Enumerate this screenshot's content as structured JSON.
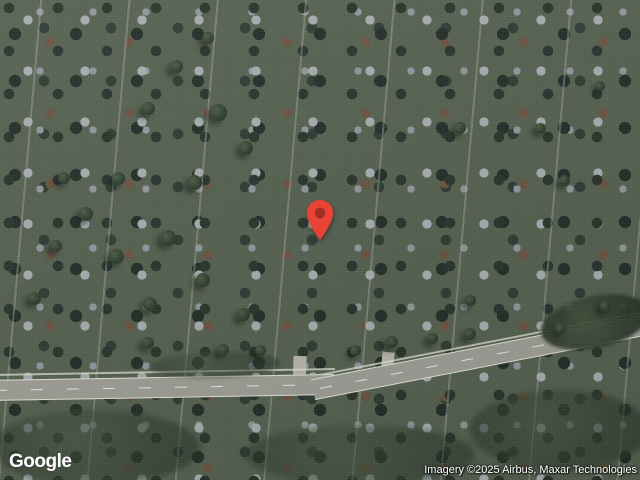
{
  "ui": {
    "logo_text": "Google",
    "attribution_text": "Imagery ©2025 Airbus, Maxar Technologies"
  },
  "marker": {
    "x": 320,
    "y": 241,
    "color": "#EA4335",
    "dot_color": "#A52E24"
  },
  "colors": {
    "pin_red": "#EA4335",
    "pin_inner": "#A52E24",
    "watermark_text": "#FFFFFF",
    "terrain_base": "#85906A",
    "road_gray": "#9C9C94",
    "roof_terracotta": "#C28166",
    "roof_white": "#EAEBE4"
  },
  "map": {
    "features": [
      {
        "n": "terrain-base",
        "x": 0,
        "y": 0,
        "w": 640,
        "h": 480,
        "bg": "linear-gradient(120deg,#8b9370 0%,#7f8a5f 45%,#87906c 100%)"
      },
      {
        "n": "field-north",
        "x": 140,
        "y": -8,
        "w": 510,
        "h": 150,
        "bg": "#7d8f55",
        "cls": "tex-field",
        "rot": -2
      },
      {
        "n": "field-northeast",
        "x": 470,
        "y": 8,
        "w": 180,
        "h": 82,
        "bg": "#95a164",
        "cls": "tex-field",
        "rot": -4,
        "op": 0.95
      },
      {
        "n": "campus-lawn",
        "x": 190,
        "y": 85,
        "w": 280,
        "h": 200,
        "bg": "radial-gradient(closest-side, #7f9052 0%, #748549 70%, rgba(116,133,73,0) 100%)"
      },
      {
        "n": "field-berm",
        "x": 241,
        "y": 26,
        "w": 212,
        "h": 76,
        "bg": "#6e7d49",
        "cls": "tex-field",
        "rot": -3,
        "br": "6px",
        "bd": "1px solid rgba(70,80,45,.55)"
      },
      {
        "n": "dirt-patch",
        "x": 286,
        "y": 58,
        "w": 54,
        "h": 18,
        "bg": "#c2b189",
        "rot": -4,
        "br": "4px"
      },
      {
        "n": "field-path",
        "x": 473,
        "y": 6,
        "w": 3,
        "h": 58,
        "bg": "rgba(225,223,210,.75)",
        "rot": 4
      },
      {
        "n": "field-shed",
        "x": 461,
        "y": 51,
        "w": 20,
        "h": 12,
        "bg": "#e3e3da",
        "rot": -8,
        "bd": "1px solid #4a4f45"
      },
      {
        "n": "suburb-northwest",
        "x": 0,
        "y": 0,
        "w": 640,
        "h": 480,
        "cls": "tex-suburb",
        "clip": "polygon(0 0, 352 0, 286 72, 224 142, 94 290, 36 330, 0 352)"
      },
      {
        "n": "tree-line",
        "x": 300,
        "y": 98,
        "w": 120,
        "h": 58,
        "cls": "dark-mass",
        "bl": 2,
        "op": 0.95
      },
      {
        "n": "tree-line",
        "x": 395,
        "y": 80,
        "w": 120,
        "h": 55,
        "cls": "dark-mass",
        "bl": 2,
        "op": 0.95
      },
      {
        "n": "tree-line",
        "x": 490,
        "y": 55,
        "w": 120,
        "h": 55,
        "cls": "dark-mass",
        "bl": 2,
        "op": 0.95
      },
      {
        "n": "tree-line",
        "x": 580,
        "y": 28,
        "w": 95,
        "h": 52,
        "cls": "dark-mass",
        "bl": 2,
        "op": 0.95
      },
      {
        "n": "tree-cluster",
        "x": 585,
        "y": -12,
        "w": 80,
        "h": 48,
        "cls": "dark-mass",
        "bl": 2,
        "op": 0.92
      },
      {
        "n": "woods-central",
        "x": 315,
        "y": 115,
        "w": 120,
        "h": 85,
        "cls": "dark-mass",
        "bl": 2,
        "op": 0.92
      },
      {
        "n": "woods-central",
        "x": 395,
        "y": 128,
        "w": 135,
        "h": 80,
        "cls": "dark-mass",
        "bl": 2,
        "op": 0.9
      },
      {
        "n": "woods-central",
        "x": 455,
        "y": 140,
        "w": 90,
        "h": 55,
        "cls": "dark-mass",
        "bl": 2,
        "op": 0.88
      },
      {
        "n": "woods-west",
        "x": 235,
        "y": 118,
        "w": 105,
        "h": 48,
        "cls": "dark-mass",
        "rot": -15,
        "bl": 2,
        "op": 0.9
      },
      {
        "n": "woods-west",
        "x": 172,
        "y": 146,
        "w": 85,
        "h": 42,
        "cls": "dark-mass",
        "rot": -25,
        "bl": 2,
        "op": 0.88
      },
      {
        "n": "suburb-edge-trees",
        "x": 288,
        "y": 30,
        "w": 90,
        "h": 48,
        "cls": "dark-mass",
        "rot": -35,
        "bl": 2,
        "op": 0.85
      },
      {
        "n": "suburb-edge-trees",
        "x": 210,
        "y": 95,
        "w": 95,
        "h": 50,
        "cls": "dark-mass",
        "rot": -38,
        "bl": 2,
        "op": 0.85
      },
      {
        "n": "suburb-edge-trees",
        "x": 130,
        "y": 190,
        "w": 90,
        "h": 50,
        "cls": "dark-mass",
        "rot": -48,
        "bl": 2,
        "op": 0.85
      },
      {
        "n": "suburb-edge-trees",
        "x": 60,
        "y": 270,
        "w": 85,
        "h": 46,
        "cls": "dark-mass",
        "rot": -40,
        "bl": 2,
        "op": 0.85
      },
      {
        "n": "suburb-edge-trees",
        "x": 5,
        "y": 330,
        "w": 70,
        "h": 42,
        "cls": "dark-mass",
        "rot": -30,
        "bl": 2,
        "op": 0.85
      },
      {
        "n": "gravel-lot",
        "x": 14,
        "y": 326,
        "w": 130,
        "h": 26,
        "bg": "#c8bfa6",
        "rot": -3,
        "br": "3px",
        "op": 0.95
      },
      {
        "n": "gravel-driveway",
        "x": 135,
        "y": 333,
        "w": 90,
        "h": 12,
        "bg": "#c2b99f",
        "rot": -2,
        "op": 0.85
      },
      {
        "n": "gravel-spur",
        "x": 52,
        "y": 298,
        "w": 24,
        "h": 34,
        "bg": "#c0b79e",
        "rot": -10,
        "op": 0.8
      },
      {
        "n": "barn",
        "x": 100,
        "y": 266,
        "w": 28,
        "h": 20,
        "bg": "#5e625a",
        "rot": 6,
        "cls": "bldg"
      },
      {
        "n": "barn",
        "x": 117,
        "y": 290,
        "w": 33,
        "h": 22,
        "bg": "#51574f",
        "rot": -4,
        "cls": "bldg"
      },
      {
        "n": "barn",
        "x": 136,
        "y": 312,
        "w": 26,
        "h": 16,
        "bg": "#6c7065",
        "rot": -4,
        "cls": "bldg"
      },
      {
        "n": "farm-path",
        "x": 150,
        "y": 255,
        "w": 75,
        "h": 4,
        "bg": "rgba(205,200,185,.6)",
        "rot": 6
      },
      {
        "n": "campus-loop-road",
        "x": 212,
        "y": 148,
        "w": 232,
        "h": 162,
        "bg": "rgba(0,0,0,0)",
        "bd": "9px solid rgba(190,188,176,.92)",
        "br": "50%",
        "rot": -8
      },
      {
        "n": "loop-parking-west",
        "x": 213,
        "y": 190,
        "w": 46,
        "h": 95,
        "bg": "rgba(193,191,179,.85)",
        "br": "50%",
        "rot": 12
      },
      {
        "n": "loop-road-north",
        "x": 255,
        "y": 146,
        "w": 90,
        "h": 22,
        "bg": "rgba(193,191,179,.8)",
        "br": "50%",
        "rot": -10
      },
      {
        "n": "service-road",
        "x": 352,
        "y": 132,
        "w": 70,
        "h": 9,
        "bg": "#b3b1a6",
        "rot": -18
      },
      {
        "n": "service-road",
        "x": 430,
        "y": 200,
        "w": 60,
        "h": 10,
        "bg": "#b3b1a6",
        "rot": -12
      },
      {
        "n": "connector-road",
        "x": 497,
        "y": 248,
        "w": 12,
        "h": 102,
        "bg": "#b3b1a6",
        "rot": 9
      },
      {
        "n": "parking-lot",
        "x": 368,
        "y": 152,
        "w": 135,
        "h": 68,
        "bg": "#a8a7a0",
        "cls": "tex-parking",
        "rot": -12,
        "br": "4px"
      },
      {
        "n": "parking-lot",
        "x": 388,
        "y": 232,
        "w": 118,
        "h": 64,
        "bg": "#a8a7a0",
        "cls": "tex-parking",
        "rot": -9,
        "br": "4px"
      },
      {
        "n": "parking-lot",
        "x": 560,
        "y": 100,
        "w": 78,
        "h": 34,
        "bg": "#a8a7a0",
        "cls": "tex-parking",
        "rot": -12,
        "br": "3px"
      },
      {
        "n": "parking-lot",
        "x": 545,
        "y": 254,
        "w": 95,
        "h": 44,
        "bg": "#a8a7a0",
        "cls": "tex-parking",
        "rot": -14,
        "br": "10px"
      },
      {
        "n": "parking-strip",
        "x": 196,
        "y": 148,
        "w": 70,
        "h": 24,
        "bg": "#b4b2a8",
        "cls": "tex-parking",
        "rot": -26,
        "br": "10px",
        "op": 0.9
      },
      {
        "n": "garden-plot",
        "x": 410,
        "y": 290,
        "w": 28,
        "h": 26,
        "bg": "#41493c",
        "bd": "2px solid #2d342b",
        "rot": -8
      },
      {
        "n": "garden-plot",
        "x": 442,
        "y": 287,
        "w": 28,
        "h": 26,
        "bg": "#8d7356",
        "bd": "2px solid #2d342b",
        "rot": -8
      },
      {
        "n": "school-building",
        "x": 436,
        "y": 170,
        "w": 74,
        "h": 26,
        "bg": "#eaebe4",
        "rot": -12,
        "cls": "bldg"
      },
      {
        "n": "school-building",
        "x": 519,
        "y": 148,
        "w": 80,
        "h": 26,
        "bg": "#e7e8e1",
        "rot": -12,
        "cls": "bldg"
      },
      {
        "n": "school-building",
        "x": 451,
        "y": 206,
        "w": 66,
        "h": 24,
        "bg": "#eaebe4",
        "rot": -12,
        "cls": "bldg"
      },
      {
        "n": "school-building",
        "x": 527,
        "y": 218,
        "w": 78,
        "h": 26,
        "bg": "#e4e5de",
        "rot": -12,
        "cls": "bldg"
      },
      {
        "n": "school-building",
        "x": 466,
        "y": 246,
        "w": 72,
        "h": 23,
        "bg": "#e9eae3",
        "rot": -12,
        "cls": "bldg"
      },
      {
        "n": "school-building",
        "x": 601,
        "y": 246,
        "w": 34,
        "h": 20,
        "bg": "#dfe0d9",
        "rot": -12,
        "cls": "bldg"
      },
      {
        "n": "school-building",
        "x": 616,
        "y": 192,
        "w": 26,
        "h": 52,
        "bg": "#d9dad2",
        "rot": -12,
        "cls": "bldg"
      },
      {
        "n": "campus-building-gray",
        "x": 270,
        "y": 204,
        "w": 64,
        "h": 48,
        "bg": "linear-gradient(140deg,#b3b8bc 0%,#8f959a 55%,#7f858a 100%)",
        "rot": -9,
        "cls": "bldg",
        "br": "2px"
      },
      {
        "n": "campus-building-gray",
        "x": 330,
        "y": 208,
        "w": 42,
        "h": 30,
        "bg": "#9aa1a6",
        "rot": -9,
        "cls": "bldg",
        "br": "2px"
      },
      {
        "n": "courtyard-roof",
        "x": 312,
        "y": 234,
        "w": 52,
        "h": 38,
        "bg": "#c28c6e",
        "rot": -9,
        "br": "3px",
        "op": 0.95
      },
      {
        "n": "building-link",
        "x": 312,
        "y": 254,
        "w": 18,
        "h": 46,
        "bg": "#bf8165",
        "rot": -4,
        "op": 0.9
      },
      {
        "n": "campus-building-orange",
        "x": 293,
        "y": 295,
        "w": 48,
        "h": 52,
        "bg": "#c07a5d",
        "rot": 45,
        "cls": "bldg",
        "br": "4px"
      },
      {
        "n": "campus-building-orange",
        "x": 291,
        "y": 299,
        "w": 56,
        "h": 44,
        "bg": "#c48166",
        "rot": -45,
        "cls": "bldg",
        "br": "4px"
      },
      {
        "n": "campus-building-center",
        "x": 306,
        "y": 309,
        "w": 26,
        "h": 24,
        "bg": "#d9c9b9",
        "rot": -8,
        "br": "2px"
      },
      {
        "n": "campus-building-white",
        "x": 330,
        "y": 320,
        "w": 24,
        "h": 26,
        "bg": "#e7e4db",
        "rot": -8,
        "cls": "bldg",
        "br": "2px"
      },
      {
        "n": "walking-path",
        "x": 178,
        "y": 170,
        "w": 48,
        "h": 3,
        "bg": "rgba(210,207,193,.7)",
        "rot": 9
      },
      {
        "n": "walking-path",
        "x": 536,
        "y": 148,
        "w": 3,
        "h": 56,
        "bg": "rgba(215,212,198,.65)",
        "rot": 18
      },
      {
        "n": "walking-path",
        "x": 352,
        "y": 300,
        "w": 3,
        "h": 54,
        "bg": "rgba(215,212,198,.6)",
        "rot": -12
      },
      {
        "n": "suburb-south",
        "x": 0,
        "y": 0,
        "w": 640,
        "h": 480,
        "cls": "tex-burbdark",
        "clip": "polygon(0 397, 330 395, 640 343, 640 480, 0 480)"
      },
      {
        "n": "entrance-road",
        "x": 293,
        "y": 356,
        "w": 13,
        "h": 34,
        "bg": "#b6b4a9",
        "rot": 2
      },
      {
        "n": "entrance-road",
        "x": 381,
        "y": 352,
        "w": 12,
        "h": 32,
        "bg": "#b6b4a9",
        "rot": 6
      },
      {
        "n": "sidewalk",
        "x": -10,
        "y": 371,
        "w": 345,
        "h": 2,
        "bg": "rgba(222,222,212,.75)",
        "rot": -1
      },
      {
        "n": "sidewalk",
        "x": 314,
        "y": 342,
        "w": 340,
        "h": 2,
        "bg": "rgba(222,222,212,.75)",
        "rot": -11
      },
      {
        "n": "main-road",
        "x": -12,
        "y": 377,
        "w": 346,
        "h": 19,
        "bg": "#9c9c94",
        "rot": -1,
        "cls": "road"
      },
      {
        "n": "main-road",
        "x": 310,
        "y": 346,
        "w": 348,
        "h": 19,
        "bg": "#9c9c94",
        "rot": -11,
        "cls": "road"
      },
      {
        "n": "tree-cluster",
        "x": 540,
        "y": 296,
        "w": 110,
        "h": 52,
        "cls": "dark-mass",
        "rot": -12,
        "bl": 1.5,
        "op": 0.92
      },
      {
        "n": "tree-cluster",
        "x": 150,
        "y": 352,
        "w": 130,
        "h": 26,
        "cls": "dark-mass",
        "rot": -2,
        "bl": 2,
        "op": 0.5
      },
      {
        "n": "tree-canopy-shadow",
        "x": -10,
        "y": 410,
        "w": 210,
        "h": 75,
        "cls": "dark-mass",
        "bl": 3,
        "op": 0.55
      },
      {
        "n": "tree-canopy-shadow",
        "x": 245,
        "y": 425,
        "w": 230,
        "h": 60,
        "cls": "dark-mass",
        "bl": 3,
        "op": 0.5
      },
      {
        "n": "tree-canopy-shadow",
        "x": 470,
        "y": 390,
        "w": 180,
        "h": 80,
        "cls": "dark-mass",
        "bl": 3,
        "op": 0.6
      }
    ],
    "trees": [
      [
        218,
        112,
        17
      ],
      [
        246,
        148,
        14
      ],
      [
        194,
        182,
        15
      ],
      [
        168,
        238,
        16
      ],
      [
        203,
        280,
        14
      ],
      [
        243,
        314,
        13
      ],
      [
        150,
        304,
        14
      ],
      [
        116,
        256,
        15
      ],
      [
        86,
        214,
        14
      ],
      [
        64,
        178,
        12
      ],
      [
        118,
        178,
        13
      ],
      [
        56,
        246,
        12
      ],
      [
        34,
        298,
        13
      ],
      [
        148,
        343,
        12
      ],
      [
        223,
        350,
        12
      ],
      [
        260,
        350,
        11
      ],
      [
        176,
        66,
        13
      ],
      [
        148,
        108,
        13
      ],
      [
        208,
        38,
        12
      ],
      [
        355,
        350,
        11
      ],
      [
        392,
        342,
        12
      ],
      [
        432,
        338,
        11
      ],
      [
        470,
        334,
        12
      ],
      [
        560,
        328,
        11
      ],
      [
        600,
        86,
        10
      ],
      [
        540,
        128,
        11
      ],
      [
        460,
        128,
        12
      ],
      [
        564,
        180,
        11
      ],
      [
        605,
        306,
        11
      ],
      [
        470,
        300,
        11
      ]
    ]
  }
}
